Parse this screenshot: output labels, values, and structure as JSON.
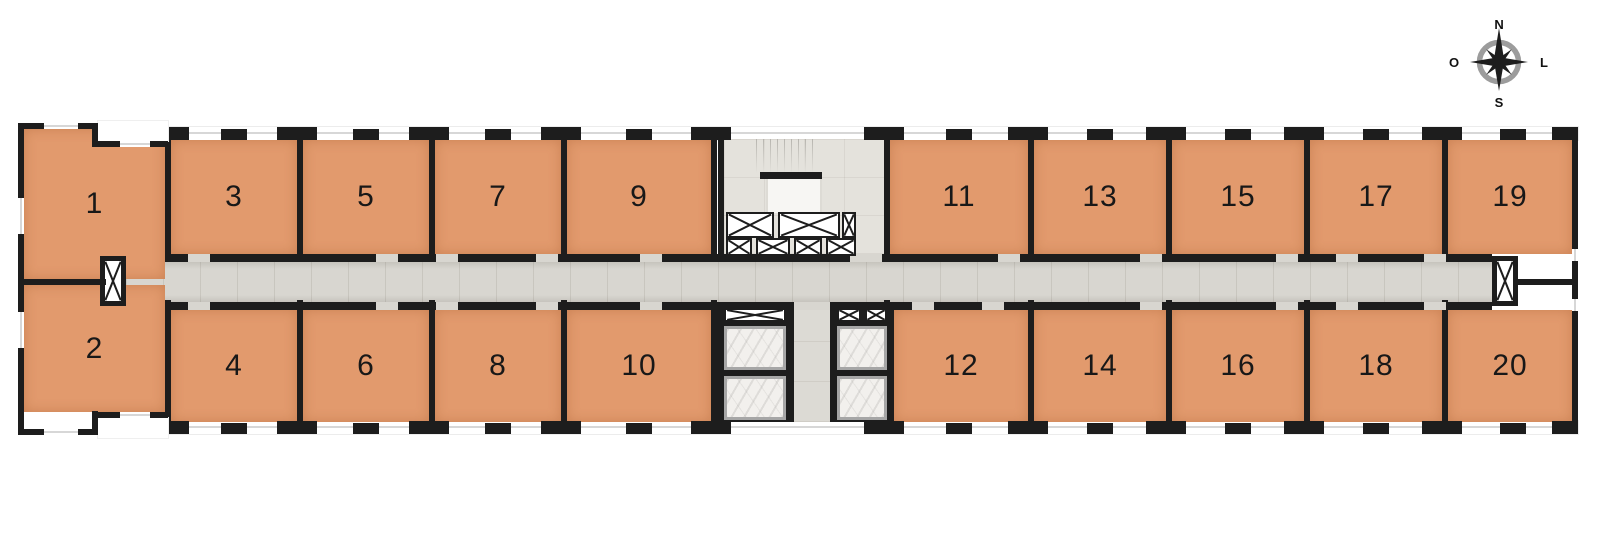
{
  "compass": {
    "north": "N",
    "east": "L",
    "south": "S",
    "west": "O"
  },
  "rooms": [
    {
      "label": "1"
    },
    {
      "label": "2"
    },
    {
      "label": "3"
    },
    {
      "label": "4"
    },
    {
      "label": "5"
    },
    {
      "label": "6"
    },
    {
      "label": "7"
    },
    {
      "label": "8"
    },
    {
      "label": "9"
    },
    {
      "label": "10"
    },
    {
      "label": "11"
    },
    {
      "label": "12"
    },
    {
      "label": "13"
    },
    {
      "label": "14"
    },
    {
      "label": "15"
    },
    {
      "label": "16"
    },
    {
      "label": "17"
    },
    {
      "label": "18"
    },
    {
      "label": "19"
    },
    {
      "label": "20"
    }
  ],
  "colors": {
    "room_fill": "#e29a6d",
    "wall": "#1d1d1d",
    "corridor_floor": "#d8d6d0",
    "stair_floor": "#e4e2dc",
    "lobby_floor": "#dcdad4",
    "elevator_frame": "#a6a6a6",
    "elevator_cab": "#f2f0ed",
    "compass_ring": "#9c9c9c",
    "background": "#ffffff"
  }
}
